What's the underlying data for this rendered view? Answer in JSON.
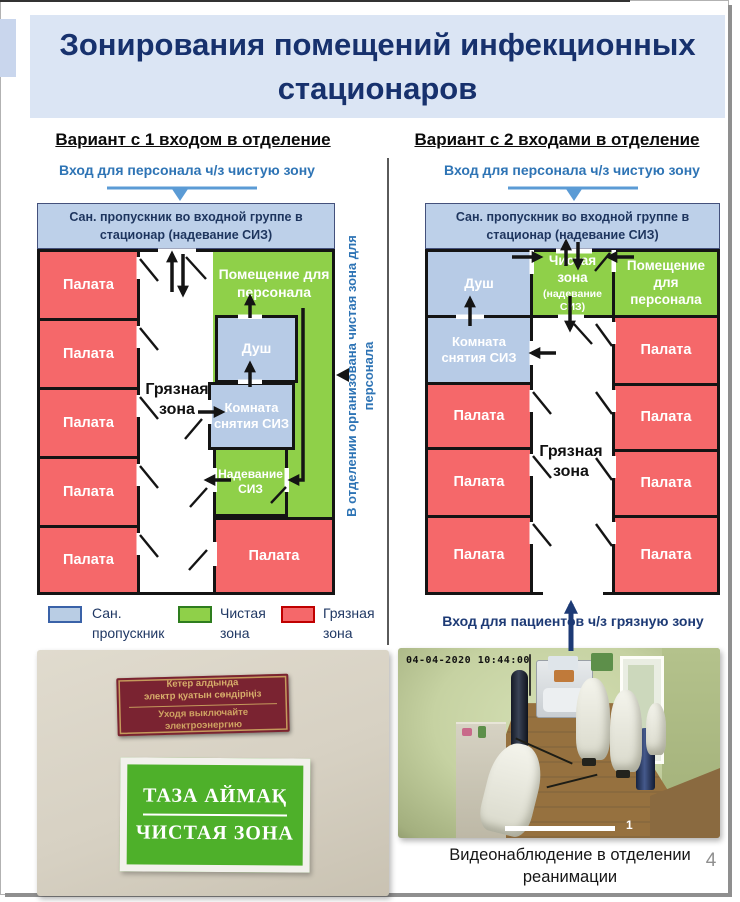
{
  "slide": {
    "title": "Зонирования помещений инфекционных стационаров",
    "page_number": "4"
  },
  "plan1": {
    "heading": "Вариант с 1 входом в отделение",
    "staff_entry": "Вход для персонала ч/з чистую зону",
    "san_checkpoint": "Сан. пропускник во входной группе в стационар (надевание СИЗ)",
    "wards": [
      "Палата",
      "Палата",
      "Палата",
      "Палата",
      "Палата"
    ],
    "ward_bottom": "Палата",
    "dirty_zone": "Грязная зона",
    "staff_room": "Помещение для персонала",
    "shower": "Душ",
    "doffing_room": "Комната снятия СИЗ",
    "donning_room": "Надевание СИЗ",
    "side_note": "В отделении организована чистая зона для персонала"
  },
  "plan2": {
    "heading": "Вариант с 2 входами в отделение",
    "staff_entry": "Вход для персонала ч/з чистую зону",
    "san_checkpoint": "Сан. пропускник во входной группе в стационар (надевание СИЗ)",
    "shower": "Душ",
    "clean_zone": "Чистая зона",
    "clean_zone_note": "(надевание СИЗ)",
    "staff_room": "Помещение для персонала",
    "doffing_room": "Комната снятия СИЗ",
    "dirty_zone": "Грязная зона",
    "wards_left": [
      "Палата",
      "Палата",
      "Палата"
    ],
    "wards_right": [
      "Палата",
      "Палата",
      "Палата",
      "Палата"
    ],
    "patient_entry": "Вход для пациентов ч/з грязную зону"
  },
  "legend": {
    "items": [
      {
        "label": "Сан. пропускник",
        "color": "#b9cde4"
      },
      {
        "label": "Чистая зона",
        "color": "#8fd049"
      },
      {
        "label": "Грязная зона",
        "color": "#f5686a"
      }
    ]
  },
  "photo_signs": {
    "red_sign_lines": [
      "Кетер алдында",
      "электр қуатын сөндіріңіз",
      "Уходя выключайте",
      "электроэнергию"
    ],
    "green_sign_lines": [
      "ТАЗА АЙМАҚ",
      "ЧИСТАЯ ЗОНА"
    ]
  },
  "photo_cctv": {
    "timestamp": "04-04-2020 10:44:00",
    "camera_number": "1",
    "caption": "Видеонаблюдение в отделении реанимации"
  },
  "colors": {
    "title_text": "#17316d",
    "san_zone": "#b9cde4",
    "clean_zone": "#8fd049",
    "dirty_zone": "#f5686a",
    "staff_entry_blue": "#2e74b5",
    "patient_entry_navy": "#1d3a75"
  }
}
